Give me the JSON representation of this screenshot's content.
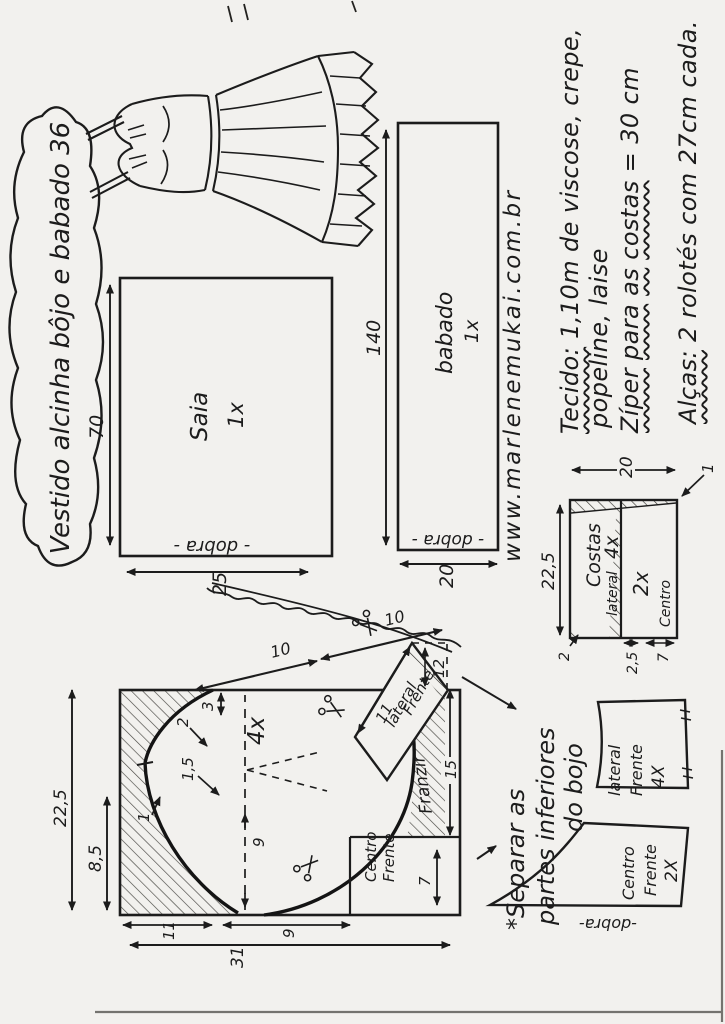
{
  "page": {
    "title": "Vestido alcinha bôjo e babado 36",
    "website": "www.marlenemukai.com.br"
  },
  "instructions": {
    "line1_label": "Tecido:",
    "line1_rest": " 1,10m de viscose, crepe,",
    "line2": "popeline, laise",
    "line3_w1": "Zíper",
    "line3_w2": "para",
    "line3_w3": "as",
    "line3_w4": "costas",
    "line3_rest": " = 30 cm",
    "line4_label": "Alças:",
    "line4_rest": " 2 rolotés com 27cm cada."
  },
  "note": {
    "line1": "*Separar as",
    "line2": "partes inferiores",
    "line3": "do bojo"
  },
  "pieces": {
    "saia": {
      "name": "Saia",
      "qty": "1x",
      "fold": "- dobra -",
      "width": "70",
      "height": "25"
    },
    "babado": {
      "name": "babado",
      "qty": "1x",
      "fold": "- dobra -",
      "width": "140",
      "height": "20"
    },
    "costas": {
      "name": "Costas",
      "qty_lateral": "4x",
      "label_lateral": "lateral",
      "qty_centro": "2x",
      "label_centro": "Centro",
      "width": "22,5",
      "height": "20",
      "d_top": "2",
      "d_mid": "2,5",
      "d_bottom": "7",
      "d_corner": "1"
    },
    "bojo": {
      "qty": "4x",
      "franzir": "Franzir",
      "centro_l1": "Centro",
      "centro_l2": "Frente",
      "flap_l1": "lateral",
      "flap_l2": "Frente",
      "width": "22,5",
      "part_width": "8,5",
      "length": "31",
      "d11": "11",
      "d9": "9",
      "d7": "7",
      "d15": "15",
      "d3": "3",
      "d2": "2",
      "d1_5": "1,5",
      "d1": "1",
      "d9_inner": "9",
      "strap_a": "10",
      "strap_b": "10",
      "flap_d12": "12",
      "flap_d11": "11"
    },
    "lateral_frente": {
      "l1": "lateral",
      "l2": "Frente",
      "qty": "4X"
    },
    "centro_frente": {
      "l1": "Centro",
      "l2": "Frente",
      "qty": "2X",
      "fold": "-dobra-"
    }
  }
}
